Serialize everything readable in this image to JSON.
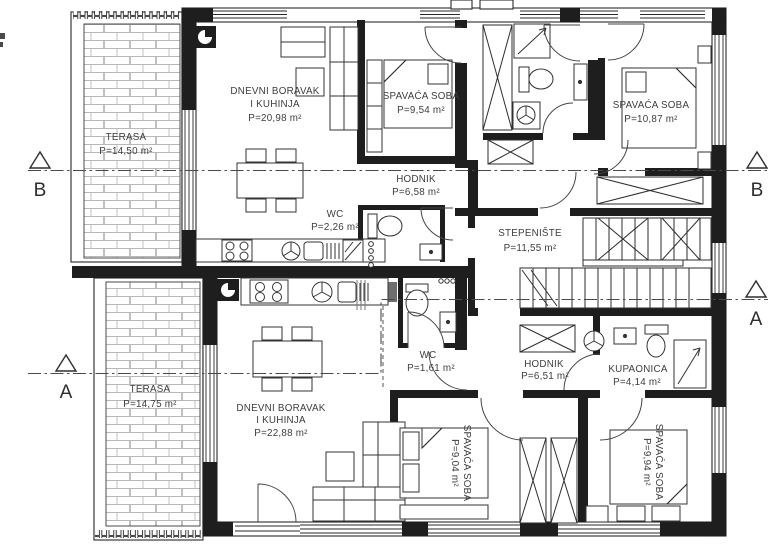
{
  "drawing": {
    "type": "architectural-floor-plan",
    "colors": {
      "wall": "#1e1e1e",
      "line": "#333333",
      "hatch": "#b8b8b8",
      "text": "#3d3d3d",
      "background": "#ffffff"
    },
    "rooms": {
      "terasa_upper": {
        "name": "TERASA",
        "area": "P=14,50 m²"
      },
      "dnevni_upper": {
        "name_line1": "DNEVNI BORAVAK",
        "name_line2": "I KUHINJA",
        "area": "P=20,98 m²"
      },
      "spavaca_upper_left": {
        "name": "SPAVAĆA SOBA",
        "area": "P=9,54 m²"
      },
      "spavaca_upper_right": {
        "name": "SPAVAĆA SOBA",
        "area": "P=10,87 m²"
      },
      "hodnik_upper": {
        "name": "HODNIK",
        "area": "P=6,58 m²"
      },
      "wc_upper": {
        "name": "WC",
        "area": "P=2,26 m²"
      },
      "stepeniste": {
        "name": "STEPENIŠTE",
        "area": "P=11,55 m²"
      },
      "terasa_lower": {
        "name": "TERASA",
        "area": "P=14,75 m²"
      },
      "dnevni_lower": {
        "name_line1": "DNEVNI BORAVAK",
        "name_line2": "I KUHINJA",
        "area": "P=22,88 m²"
      },
      "wc_lower": {
        "name": "WC",
        "area": "P=1,61 m²"
      },
      "hodnik_lower": {
        "name": "HODNIK",
        "area": "P=6,51 m²"
      },
      "kupaonica": {
        "name": "KUPAONICA",
        "area": "P=4,14 m²"
      },
      "spavaca_lower_mid": {
        "name": "SPAVAĆA SOBA",
        "area": "P=9,04 m²"
      },
      "spavaca_lower_right": {
        "name": "SPAVAĆA SOBA",
        "area": "P=9,94 m²"
      }
    },
    "section_markers": {
      "b_left": "B",
      "b_right": "B",
      "a_left": "A",
      "a_right": "A"
    }
  }
}
